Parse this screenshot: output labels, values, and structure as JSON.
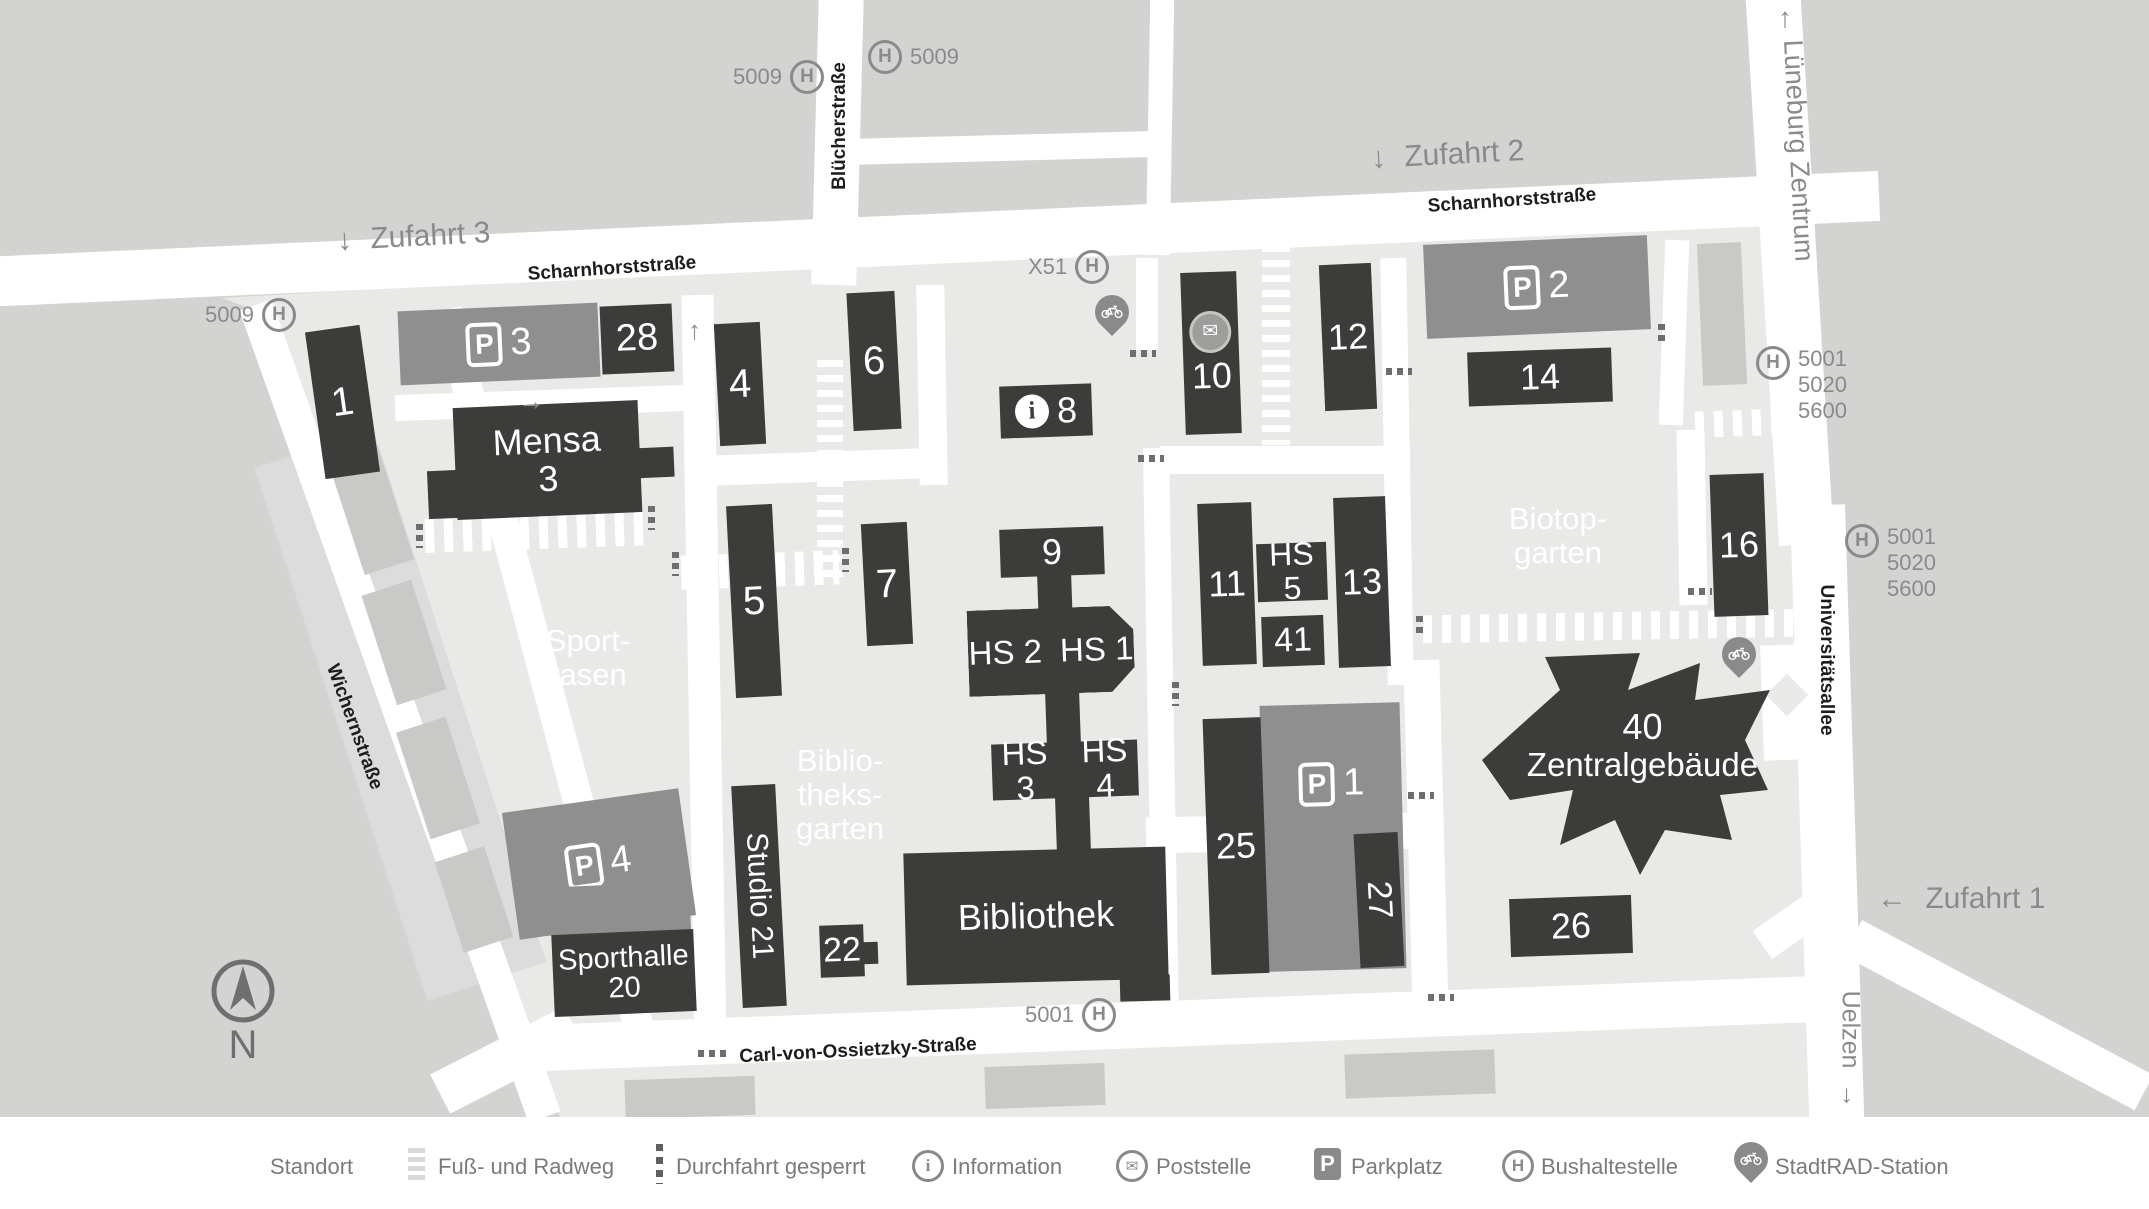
{
  "colors": {
    "outer_bg": "#d3d3d2",
    "campus_bg": "#e9e9e8",
    "road": "#ffffff",
    "building_dark": "#3c3c3b",
    "parking_gray": "#8f8f90",
    "building_light": "#c9c9c8",
    "muted_text": "#8a8a8a",
    "street_text": "#1d1d1b",
    "legend_text": "#7b7b7b"
  },
  "directions": {
    "zufahrt1": "Zufahrt 1",
    "zufahrt2": "Zufahrt 2",
    "zufahrt3": "Zufahrt 3",
    "lueneburg_zentrum": "Lüneburg Zentrum",
    "uelzen": "Uelzen",
    "arrow_down": "↓",
    "arrow_left": "←",
    "arrow_up": "↑",
    "arrow_right": "→"
  },
  "streets": {
    "scharnhorst_west": "Scharnhorststraße",
    "scharnhorst_east": "Scharnhorststraße",
    "bluecherstrasse": "Blücherstraße",
    "wichernstrasse": "Wichernstraße",
    "carl_von_ossietzky": "Carl-von-Ossietzky-Straße",
    "universitaetsallee": "Universitätsallee"
  },
  "bus": {
    "h": "H",
    "stop_west": "5009",
    "stop_bluecher_west": "5009",
    "stop_bluecher_east": "5009",
    "stop_x51": "X51",
    "stop_carl": "5001",
    "stop_east_upper": {
      "l1": "5001",
      "l2": "5020",
      "l3": "5600"
    },
    "stop_east_mid": {
      "l1": "5001",
      "l2": "5020",
      "l3": "5600"
    }
  },
  "areas": {
    "sportrasen_l1": "Sport-",
    "sportrasen_l2": "rasen",
    "bibgarten_l1": "Biblio-",
    "bibgarten_l2": "theks-",
    "bibgarten_l3": "garten",
    "biotop_l1": "Biotop-",
    "biotop_l2": "garten"
  },
  "buildings": {
    "b1": "1",
    "b4": "4",
    "b5": "5",
    "b6": "6",
    "b7": "7",
    "b8": "8",
    "b9": "9",
    "b10": "10",
    "b11": "11",
    "b12": "12",
    "b13": "13",
    "b14": "14",
    "b16": "16",
    "b22": "22",
    "b25": "25",
    "b26": "26",
    "b27": "27",
    "b28": "28",
    "b41": "41",
    "hs1": "HS 1",
    "hs2": "HS 2",
    "hs3": "HS 3",
    "hs4": "HS 4",
    "hs5": "HS 5",
    "mensa_l1": "Mensa",
    "mensa_l2": "3",
    "sporthalle_l1": "Sporthalle",
    "sporthalle_l2": "20",
    "studio21": "Studio 21",
    "bibliothek": "Bibliothek",
    "zentral_l1": "40",
    "zentral_l2": "Zentralgebäude"
  },
  "parking": {
    "p": "P",
    "p1": "1",
    "p2": "2",
    "p3": "3",
    "p4": "4"
  },
  "icons": {
    "info_glyph": "i",
    "mail_glyph": "✉",
    "compass_n": "N"
  },
  "legend": {
    "standort": "Standort",
    "fussradweg": "Fuß- und Radweg",
    "durchfahrt": "Durchfahrt gesperrt",
    "information": "Information",
    "poststelle": "Poststelle",
    "parkplatz": "Parkplatz",
    "bushaltestelle": "Bushaltestelle",
    "stadtrad": "StadtRAD-Station"
  }
}
